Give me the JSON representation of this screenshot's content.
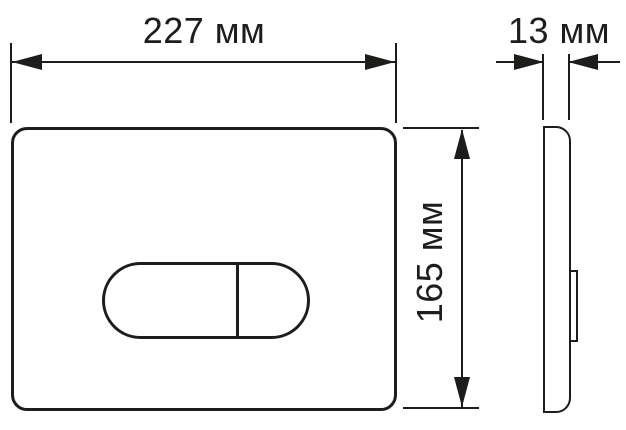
{
  "drawing": {
    "background_color": "#ffffff",
    "line_color": "#1d1d1b",
    "views": {
      "front": "flush-plate-front-view",
      "side": "flush-plate-side-view"
    },
    "dimensions": {
      "width_label": "227 мм",
      "height_label": "165 мм",
      "depth_label": "13 мм"
    }
  }
}
